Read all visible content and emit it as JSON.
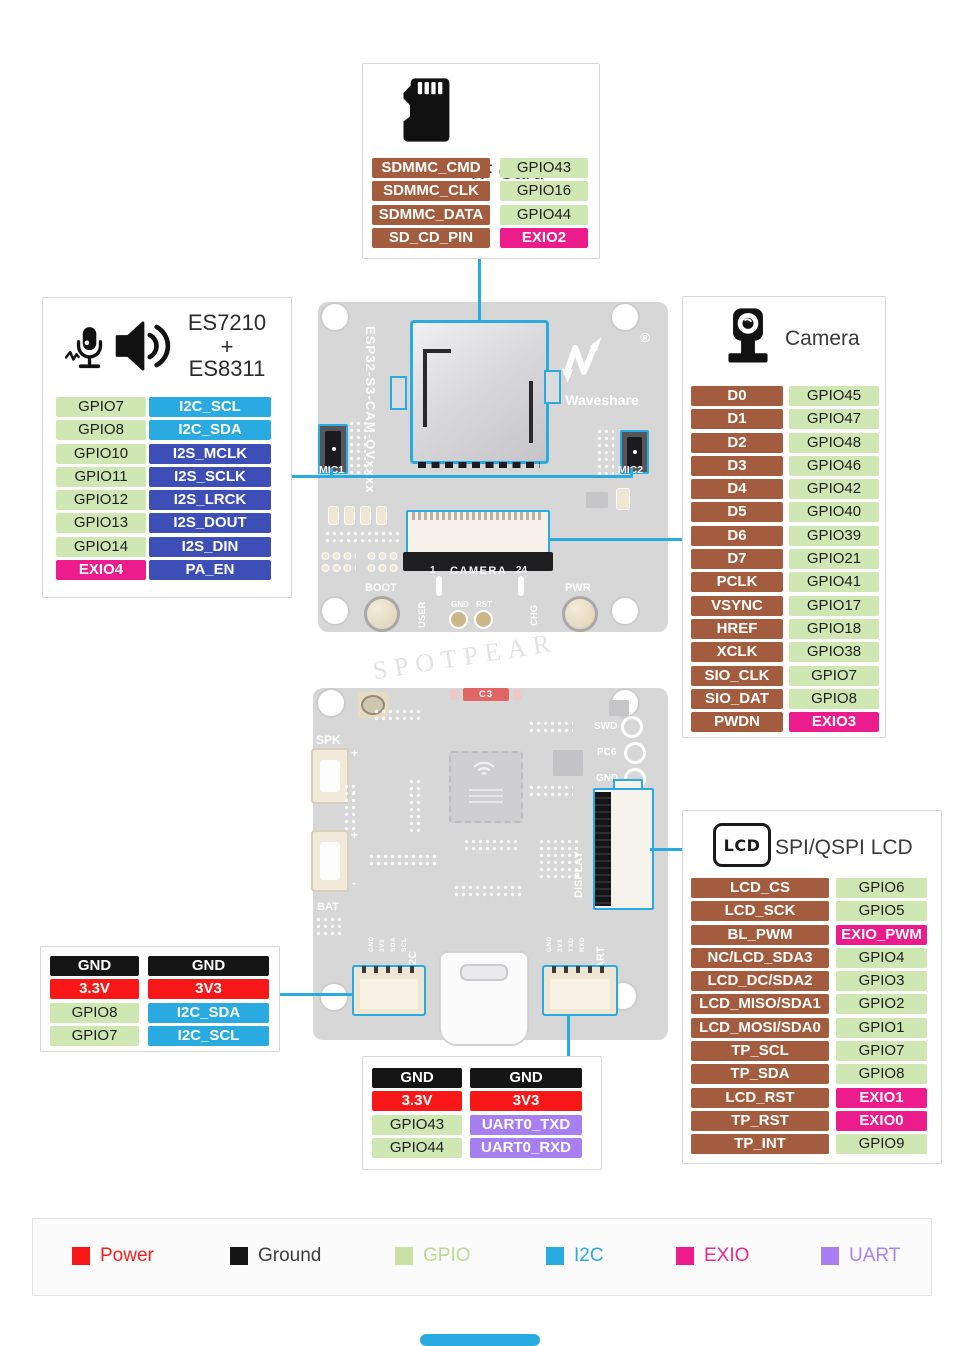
{
  "colors": {
    "power": "#fa1717",
    "ground": "#151515",
    "gpio": "#cfe7b2",
    "i2c": "#29abe2",
    "i2s": "#3e4eb7",
    "exio": "#ec1c8d",
    "uart": "#a87ff0",
    "peripheral_brown": "#a35d3e",
    "connector_line": "#29abe2"
  },
  "tf_card": {
    "title": "TF Card",
    "rows": [
      {
        "left": "SDMMC_CMD",
        "left_type": "peripheral",
        "right": "GPIO43",
        "right_type": "gpio"
      },
      {
        "left": "SDMMC_CLK",
        "left_type": "peripheral",
        "right": "GPIO16",
        "right_type": "gpio"
      },
      {
        "left": "SDMMC_DATA",
        "left_type": "peripheral",
        "right": "GPIO44",
        "right_type": "gpio"
      },
      {
        "left": "SD_CD_PIN",
        "left_type": "peripheral",
        "right": "EXIO2",
        "right_type": "exio"
      }
    ]
  },
  "audio": {
    "title_line1": "ES7210",
    "title_line2": "+",
    "title_line3": "ES8311",
    "rows": [
      {
        "left": "GPIO7",
        "left_type": "gpio",
        "right": "I2C_SCL",
        "right_type": "i2c"
      },
      {
        "left": "GPIO8",
        "left_type": "gpio",
        "right": "I2C_SDA",
        "right_type": "i2c"
      },
      {
        "left": "GPIO10",
        "left_type": "gpio",
        "right": "I2S_MCLK",
        "right_type": "i2s"
      },
      {
        "left": "GPIO11",
        "left_type": "gpio",
        "right": "I2S_SCLK",
        "right_type": "i2s"
      },
      {
        "left": "GPIO12",
        "left_type": "gpio",
        "right": "I2S_LRCK",
        "right_type": "i2s"
      },
      {
        "left": "GPIO13",
        "left_type": "gpio",
        "right": "I2S_DOUT",
        "right_type": "i2s"
      },
      {
        "left": "GPIO14",
        "left_type": "gpio",
        "right": "I2S_DIN",
        "right_type": "i2s"
      },
      {
        "left": "EXIO4",
        "left_type": "exio",
        "right": "PA_EN",
        "right_type": "i2s"
      }
    ]
  },
  "camera": {
    "title": "Camera",
    "rows": [
      {
        "left": "D0",
        "left_type": "peripheral",
        "right": "GPIO45",
        "right_type": "gpio"
      },
      {
        "left": "D1",
        "left_type": "peripheral",
        "right": "GPIO47",
        "right_type": "gpio"
      },
      {
        "left": "D2",
        "left_type": "peripheral",
        "right": "GPIO48",
        "right_type": "gpio"
      },
      {
        "left": "D3",
        "left_type": "peripheral",
        "right": "GPIO46",
        "right_type": "gpio"
      },
      {
        "left": "D4",
        "left_type": "peripheral",
        "right": "GPIO42",
        "right_type": "gpio"
      },
      {
        "left": "D5",
        "left_type": "peripheral",
        "right": "GPIO40",
        "right_type": "gpio"
      },
      {
        "left": "D6",
        "left_type": "peripheral",
        "right": "GPIO39",
        "right_type": "gpio"
      },
      {
        "left": "D7",
        "left_type": "peripheral",
        "right": "GPIO21",
        "right_type": "gpio"
      },
      {
        "left": "PCLK",
        "left_type": "peripheral",
        "right": "GPIO41",
        "right_type": "gpio"
      },
      {
        "left": "VSYNC",
        "left_type": "peripheral",
        "right": "GPIO17",
        "right_type": "gpio"
      },
      {
        "left": "HREF",
        "left_type": "peripheral",
        "right": "GPIO18",
        "right_type": "gpio"
      },
      {
        "left": "XCLK",
        "left_type": "peripheral",
        "right": "GPIO38",
        "right_type": "gpio"
      },
      {
        "left": "SIO_CLK",
        "left_type": "peripheral",
        "right": "GPIO7",
        "right_type": "gpio"
      },
      {
        "left": "SIO_DAT",
        "left_type": "peripheral",
        "right": "GPIO8",
        "right_type": "gpio"
      },
      {
        "left": "PWDN",
        "left_type": "peripheral",
        "right": "EXIO3",
        "right_type": "exio"
      }
    ]
  },
  "lcd": {
    "icon_label": "LCD",
    "title": "SPI/QSPI LCD",
    "rows": [
      {
        "left": "LCD_CS",
        "left_type": "peripheral",
        "right": "GPIO6",
        "right_type": "gpio"
      },
      {
        "left": "LCD_SCK",
        "left_type": "peripheral",
        "right": "GPIO5",
        "right_type": "gpio"
      },
      {
        "left": "BL_PWM",
        "left_type": "peripheral",
        "right": "EXIO_PWM",
        "right_type": "exio"
      },
      {
        "left": "NC/LCD_SDA3",
        "left_type": "peripheral",
        "right": "GPIO4",
        "right_type": "gpio"
      },
      {
        "left": "LCD_DC/SDA2",
        "left_type": "peripheral",
        "right": "GPIO3",
        "right_type": "gpio"
      },
      {
        "left": "LCD_MISO/SDA1",
        "left_type": "peripheral",
        "right": "GPIO2",
        "right_type": "gpio"
      },
      {
        "left": "LCD_MOSI/SDA0",
        "left_type": "peripheral",
        "right": "GPIO1",
        "right_type": "gpio"
      },
      {
        "left": "TP_SCL",
        "left_type": "peripheral",
        "right": "GPIO7",
        "right_type": "gpio"
      },
      {
        "left": "TP_SDA",
        "left_type": "peripheral",
        "right": "GPIO8",
        "right_type": "gpio"
      },
      {
        "left": "LCD_RST",
        "left_type": "peripheral",
        "right": "EXIO1",
        "right_type": "exio"
      },
      {
        "left": "TP_RST",
        "left_type": "peripheral",
        "right": "EXIO0",
        "right_type": "exio"
      },
      {
        "left": "TP_INT",
        "left_type": "peripheral",
        "right": "GPIO9",
        "right_type": "gpio"
      }
    ]
  },
  "i2c_header": {
    "rows": [
      {
        "left": "GND",
        "left_type": "ground",
        "right": "GND",
        "right_type": "ground"
      },
      {
        "left": "3.3V",
        "left_type": "power",
        "right": "3V3",
        "right_type": "power"
      },
      {
        "left": "GPIO8",
        "left_type": "gpio",
        "right": "I2C_SDA",
        "right_type": "i2c"
      },
      {
        "left": "GPIO7",
        "left_type": "gpio",
        "right": "I2C_SCL",
        "right_type": "i2c"
      }
    ]
  },
  "uart_header": {
    "rows": [
      {
        "left": "GND",
        "left_type": "ground",
        "right": "GND",
        "right_type": "ground"
      },
      {
        "left": "3.3V",
        "left_type": "power",
        "right": "3V3",
        "right_type": "power"
      },
      {
        "left": "GPIO43",
        "left_type": "gpio",
        "right": "UART0_TXD",
        "right_type": "uart"
      },
      {
        "left": "GPIO44",
        "left_type": "gpio",
        "right": "UART0_RXD",
        "right_type": "uart"
      }
    ]
  },
  "legend": {
    "items": [
      {
        "type": "power",
        "label": "Power"
      },
      {
        "type": "ground",
        "label": "Ground"
      },
      {
        "type": "gpio",
        "label": "GPIO"
      },
      {
        "type": "i2c",
        "label": "I2C"
      },
      {
        "type": "exio",
        "label": "EXIO"
      },
      {
        "type": "uart",
        "label": "UART"
      }
    ]
  },
  "board_top": {
    "model": "ESP32-S3-CAM-OVxxxx",
    "brand": "Waveshare",
    "reg": "®",
    "mic1": "MIC1",
    "mic2": "MIC2",
    "boot": "BOOT",
    "user": "USER",
    "pin1": "1",
    "camera_label": "CAMERA",
    "pin24": "24",
    "gnd": "GND",
    "rst": "RST",
    "chg": "CHG",
    "pwr": "PWR",
    "watermark": "SPOTPEAR"
  },
  "board_bottom": {
    "spk": "SPK",
    "c3": "C3",
    "swd": "SWD",
    "pc6": "PC6",
    "gnd": "GND",
    "bat": "BAT",
    "i2c": "I2C",
    "uart": "UART",
    "display": "DISPLAY",
    "plus": "+",
    "minus": "-",
    "i2c_pins": [
      "GND",
      "3V3",
      "SDA",
      "SCL"
    ],
    "uart_pins": [
      "GND",
      "3V3",
      "TXD",
      "RXD"
    ]
  }
}
